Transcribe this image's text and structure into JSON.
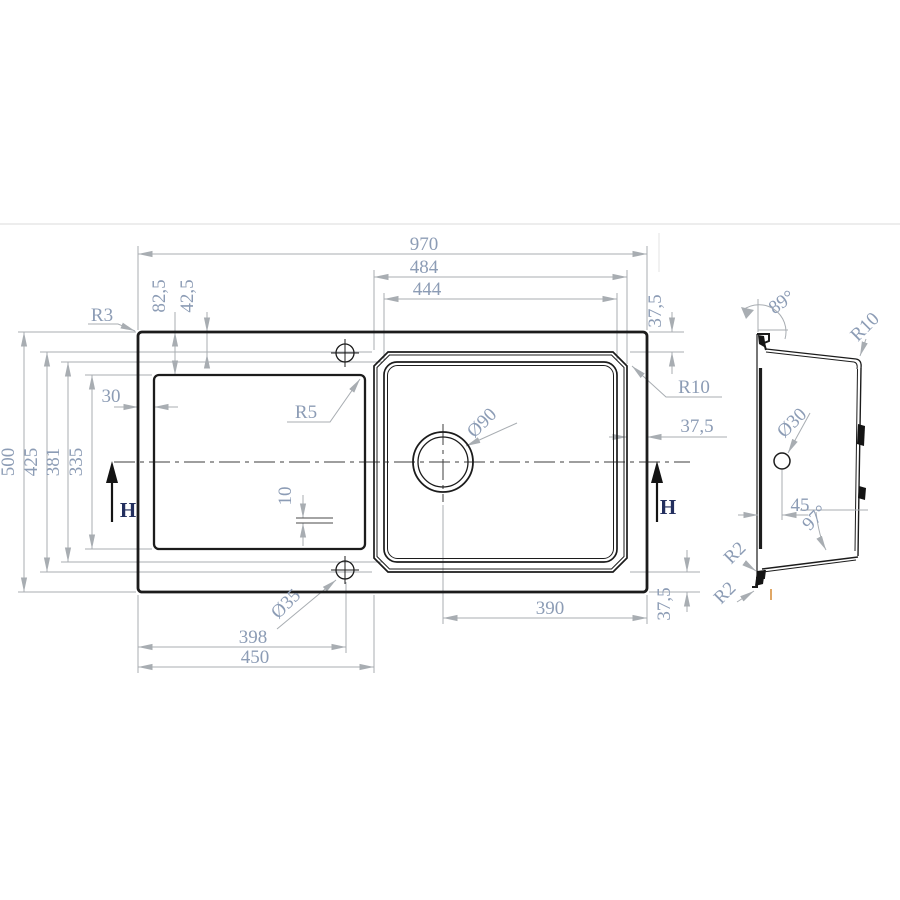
{
  "drawing": {
    "type": "technical-dimension-drawing",
    "subject": "kitchen sink with drainboard — top view and side section view",
    "colors": {
      "outline": "#1c1c1c",
      "dimension_lines": "#a8adb2",
      "dimension_text": "#8c9cb5",
      "section_label": "#232f5e",
      "artifact_orange": "#d9913f",
      "artifact_band": "#ededed"
    }
  },
  "top_view": {
    "dim_970": "970",
    "dim_484": "484",
    "dim_444": "444",
    "dim_37_5_top_right": "37,5",
    "dim_82_5": "82,5",
    "dim_42_5": "42,5",
    "dim_30": "30",
    "dim_500": "500",
    "dim_425": "425",
    "dim_381": "381",
    "dim_335": "335",
    "dim_10": "10",
    "dim_398": "398",
    "dim_450": "450",
    "dim_390": "390",
    "dim_37_5_right": "37,5",
    "dim_37_5_bottom_right": "37,5",
    "radius_r3": "R3",
    "radius_r5": "R5",
    "radius_r10": "R10",
    "dia_drain": "Ø90",
    "dia_tap_hole": "Ø35",
    "section_arrow_left": "H",
    "section_arrow_right": "H"
  },
  "side_view": {
    "angle_89": "89°",
    "angle_97": "97°",
    "radius_r10": "R10",
    "radius_r2_upper": "R2",
    "radius_r2_lower": "R2",
    "dia_tap_hole": "Ø30",
    "dim_45": "45"
  }
}
